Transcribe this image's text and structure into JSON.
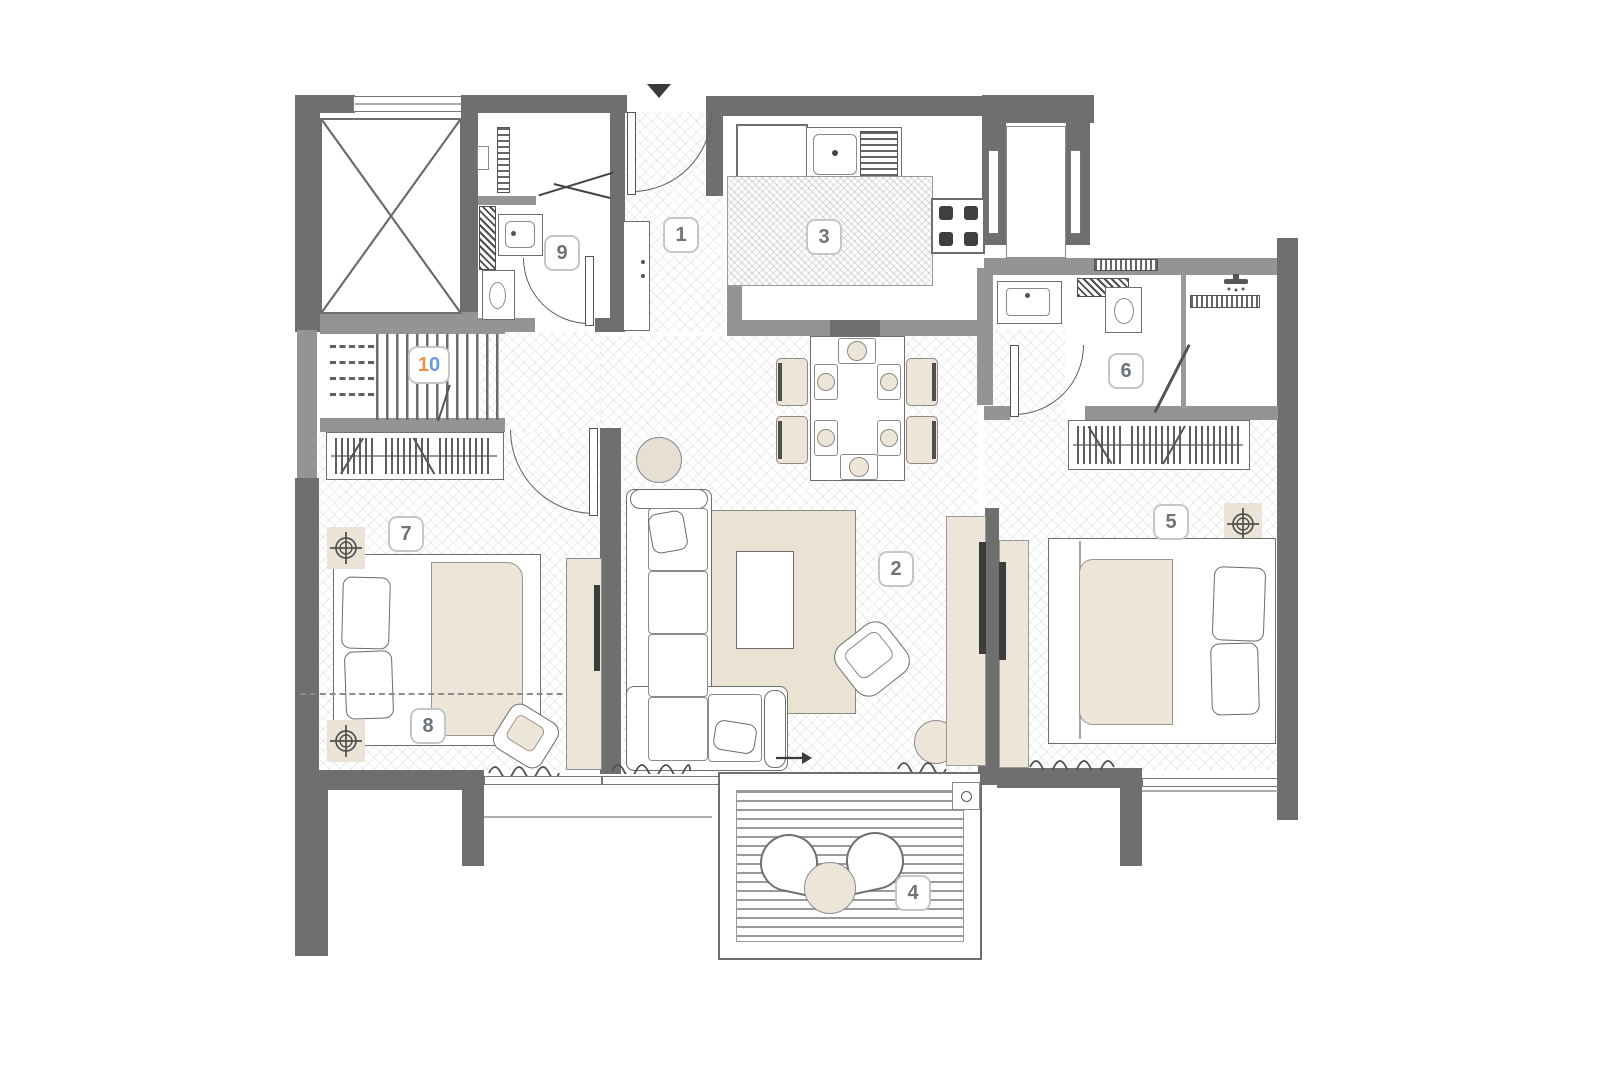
{
  "plan": {
    "title": "apartment-floor-plan",
    "colors": {
      "wall_dark": "#6f6f6f",
      "wall_medium": "#949494",
      "furniture_beige": "#ece5d8",
      "rug_beige": "#eae3d4",
      "label_border": "#c6c6c6",
      "label_text": "#6d737b",
      "accent_orange": "#e2944a",
      "accent_blue": "#699fd6"
    },
    "entry": {
      "marker": "entry-arrow"
    },
    "rooms": [
      {
        "number": "1",
        "name": "entrance-foyer"
      },
      {
        "number": "2",
        "name": "living-dining"
      },
      {
        "number": "3",
        "name": "kitchen"
      },
      {
        "number": "4",
        "name": "balcony"
      },
      {
        "number": "5",
        "name": "bedroom-right"
      },
      {
        "number": "6",
        "name": "bathroom-right"
      },
      {
        "number": "7",
        "name": "bedroom-left"
      },
      {
        "number": "8",
        "name": "bedroom-left-sleep-zone"
      },
      {
        "number": "9",
        "name": "bathroom-left"
      },
      {
        "number": "10",
        "name": "staircase",
        "digits": [
          {
            "char": "1",
            "color": "#e2944a"
          },
          {
            "char": "0",
            "color": "#699fd6"
          }
        ]
      }
    ]
  }
}
